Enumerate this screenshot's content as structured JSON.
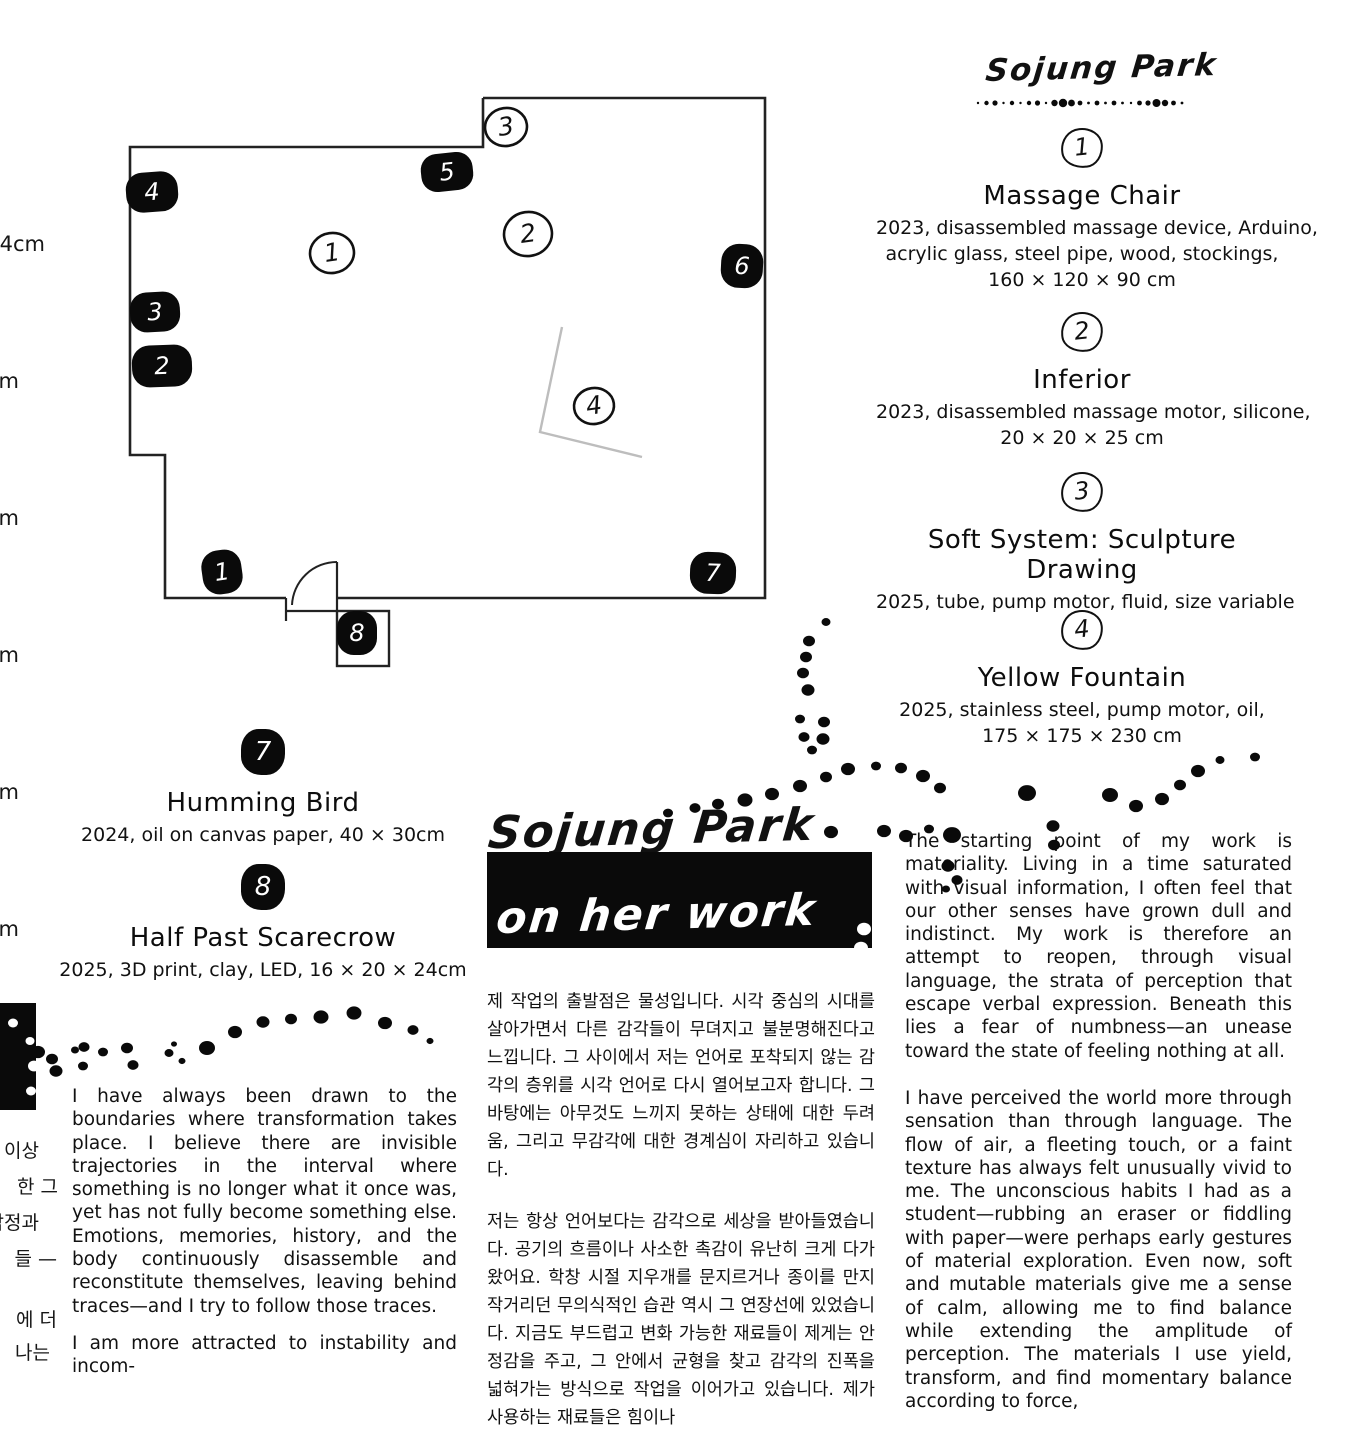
{
  "page": {
    "background": "#ffffff",
    "ink": "#111111",
    "gray_line": "#bdbdbd"
  },
  "right_header": {
    "artist_name": "Sojung Park"
  },
  "works_right": [
    {
      "num": "1",
      "title": "Massage Chair",
      "captions": [
        "2023, disassembled massage device, Arduino,",
        "acrylic glass, steel pipe, wood, stockings,",
        "160 × 120 × 90 cm"
      ]
    },
    {
      "num": "2",
      "title": "Inferior",
      "captions": [
        "2023, disassembled massage motor, silicone,",
        "20 × 20 × 25 cm"
      ]
    },
    {
      "num": "3",
      "title": "Soft System: Sculpture Drawing",
      "captions": [
        "2025, tube, pump motor, fluid, size variable"
      ]
    },
    {
      "num": "4",
      "title": "Yellow Fountain",
      "captions": [
        "2025, stainless steel, pump motor, oil,",
        "175 × 175 × 230 cm"
      ]
    }
  ],
  "works_left": [
    {
      "num": "7",
      "title": "Humming Bird",
      "captions": [
        "2024, oil on canvas paper, 40 × 30cm"
      ]
    },
    {
      "num": "8",
      "title": "Half Past Scarecrow",
      "captions": [
        "2025, 3D print, clay, LED, 16 × 20 × 24cm"
      ]
    }
  ],
  "statement": {
    "artist_name": "Sojung Park",
    "subtitle": "on her work",
    "korean_paragraphs": [
      "제 작업의 출발점은 물성입니다. 시각 중심의 시대를 살아가면서 다른 감각들이 무뎌지고 불분명해진다고 느낍니다. 그 사이에서 저는 언어로 포착되지 않는 감각의 층위를 시각 언어로 다시 열어보고자 합니다. 그 바탕에는 아무것도 느끼지 못하는 상태에 대한 두려움, 그리고 무감각에 대한 경계심이 자리하고 있습니다.",
      "저는 항상 언어보다는 감각으로 세상을 받아들였습니다. 공기의 흐름이나 사소한 촉감이 유난히 크게 다가왔어요. 학창 시절 지우개를 문지르거나 종이를 만지작거리던 무의식적인 습관 역시 그 연장선에 있었습니다. 지금도 부드럽고 변화 가능한 재료들이 제게는 안정감을 주고, 그 안에서 균형을 찾고 감각의 진폭을 넓혀가는 방식으로 작업을 이어가고 있습니다. 제가 사용하는 재료들은 힘이나"
    ],
    "english_left_paragraphs": [
      "I have always been drawn to the boundaries where transformation takes place. I believe there are invisible trajectories in the interval where something is no longer what it once was, yet has not fully become something else. Emotions, memories, history, and the body continuously disassemble and reconstitute themselves, leaving behind traces—and I try to follow those traces.",
      "I am more attracted to instability and incom-"
    ],
    "english_right_paragraphs": [
      "The starting point of my work is materiality. Living in a time saturated with visual information, I often feel that our other senses have grown dull and indistinct. My work is therefore an attempt to reopen, through visual language, the strata of perception that escape verbal expression. Beneath this lies a fear of numbness—an unease toward the state of feeling nothing at all.",
      "I have perceived the world more through sensation than through language. The flow of air, a fleeting touch, or a faint texture has always felt unusually vivid to me. The unconscious habits I had as a student—rubbing an eraser or fiddling with paper—were perhaps early gestures of material exploration. Even now, soft and mutable materials give me a sense of calm, allowing me to find balance while extending the amplitude of perception. The materials I use yield, transform, and find momentary balance according to force,"
    ]
  },
  "edge_fragments": {
    "top": [
      {
        "text": "4cm",
        "y": 232,
        "right": 45
      },
      {
        "text": "m",
        "y": 369,
        "right": 19
      },
      {
        "text": "m",
        "y": 506,
        "right": 19
      },
      {
        "text": "m",
        "y": 643,
        "right": 19
      },
      {
        "text": "m",
        "y": 780,
        "right": 19
      },
      {
        "text": "m",
        "y": 917,
        "right": 19
      }
    ],
    "korean": [
      {
        "text": "이상",
        "y": 1136,
        "right": 39
      },
      {
        "text": "한 그",
        "y": 1172,
        "right": 58
      },
      {
        "text": "감정과",
        "y": 1208,
        "right": 39
      },
      {
        "text": "들 —",
        "y": 1244,
        "right": 57
      },
      {
        "text": "에 더",
        "y": 1305,
        "right": 57
      },
      {
        "text": "나는",
        "y": 1338,
        "right": 50
      }
    ]
  },
  "floor_plan": {
    "circle_markers": [
      {
        "n": "1",
        "x": 332,
        "y": 253,
        "r": 22
      },
      {
        "n": "2",
        "x": 528,
        "y": 234,
        "r": 24
      },
      {
        "n": "3",
        "x": 506,
        "y": 127,
        "r": 21
      },
      {
        "n": "4",
        "x": 594,
        "y": 406,
        "r": 20
      }
    ],
    "pill_markers": [
      {
        "n": "4",
        "x": 152,
        "y": 192,
        "w": 52,
        "h": 40,
        "rot": -4
      },
      {
        "n": "5",
        "x": 447,
        "y": 172,
        "w": 52,
        "h": 38,
        "rot": -6
      },
      {
        "n": "6",
        "x": 742,
        "y": 266,
        "w": 42,
        "h": 44,
        "rot": 3
      },
      {
        "n": "3",
        "x": 155,
        "y": 312,
        "w": 50,
        "h": 40,
        "rot": -3
      },
      {
        "n": "2",
        "x": 162,
        "y": 366,
        "w": 60,
        "h": 42,
        "rot": -2
      },
      {
        "n": "1",
        "x": 222,
        "y": 572,
        "w": 40,
        "h": 44,
        "rot": -8
      },
      {
        "n": "7",
        "x": 713,
        "y": 573,
        "w": 46,
        "h": 42,
        "rot": 2
      },
      {
        "n": "8",
        "x": 357,
        "y": 633,
        "w": 40,
        "h": 44,
        "rot": 0
      }
    ]
  },
  "decor": {
    "bottom_left_box": {
      "x": 0,
      "y": 1003,
      "w": 36,
      "h": 107
    },
    "white_dots": [
      [
        13,
        1023,
        5
      ],
      [
        30,
        1041,
        4.5
      ],
      [
        34,
        1066,
        6
      ],
      [
        31,
        1091,
        5
      ],
      [
        864,
        929,
        7
      ],
      [
        861,
        948,
        7
      ]
    ],
    "black_dots": [
      [
        38,
        1052,
        7
      ],
      [
        52,
        1059,
        6
      ],
      [
        56,
        1071,
        6.5
      ],
      [
        75,
        1050,
        4
      ],
      [
        84,
        1047,
        5.5
      ],
      [
        103,
        1052,
        5
      ],
      [
        83,
        1066,
        5
      ],
      [
        127,
        1048,
        6
      ],
      [
        133,
        1065,
        5.5
      ],
      [
        174,
        1044,
        3
      ],
      [
        169,
        1053,
        4.5
      ],
      [
        182,
        1061,
        3.5
      ],
      [
        207,
        1048,
        8
      ],
      [
        235,
        1032,
        7
      ],
      [
        263,
        1022,
        6.5
      ],
      [
        291,
        1019,
        6
      ],
      [
        321,
        1017,
        7.5
      ],
      [
        354,
        1013,
        7.5
      ],
      [
        385,
        1023,
        7
      ],
      [
        413,
        1030,
        5.5
      ],
      [
        430,
        1041,
        3.5
      ],
      [
        826,
        622,
        4.5
      ],
      [
        809,
        641,
        6
      ],
      [
        806,
        657,
        6
      ],
      [
        803,
        673,
        6
      ],
      [
        808,
        690,
        6.5
      ],
      [
        800,
        719,
        5
      ],
      [
        824,
        722,
        6
      ],
      [
        804,
        737,
        5.5
      ],
      [
        823,
        739,
        6.5
      ],
      [
        812,
        750,
        5
      ],
      [
        848,
        769,
        7
      ],
      [
        826,
        777,
        6
      ],
      [
        800,
        786,
        7
      ],
      [
        772,
        794,
        7
      ],
      [
        745,
        800,
        7.5
      ],
      [
        718,
        804,
        6
      ],
      [
        695,
        808,
        5.5
      ],
      [
        668,
        813,
        5
      ],
      [
        831,
        832,
        7
      ],
      [
        884,
        831,
        7
      ],
      [
        876,
        766,
        5
      ],
      [
        901,
        768,
        6
      ],
      [
        923,
        776,
        7
      ],
      [
        940,
        788,
        6
      ],
      [
        906,
        836,
        7
      ],
      [
        929,
        829,
        5
      ],
      [
        952,
        835,
        9
      ],
      [
        948,
        866,
        6.5
      ],
      [
        957,
        880,
        5.5
      ],
      [
        946,
        889,
        4
      ],
      [
        1027,
        793,
        9
      ],
      [
        1053,
        826,
        6.5
      ],
      [
        1054,
        845,
        6
      ],
      [
        1110,
        795,
        8
      ],
      [
        1136,
        806,
        7
      ],
      [
        1162,
        799,
        7
      ],
      [
        1180,
        785,
        6
      ],
      [
        1198,
        771,
        7
      ],
      [
        1220,
        760,
        4.5
      ],
      [
        1255,
        757,
        5
      ]
    ]
  }
}
